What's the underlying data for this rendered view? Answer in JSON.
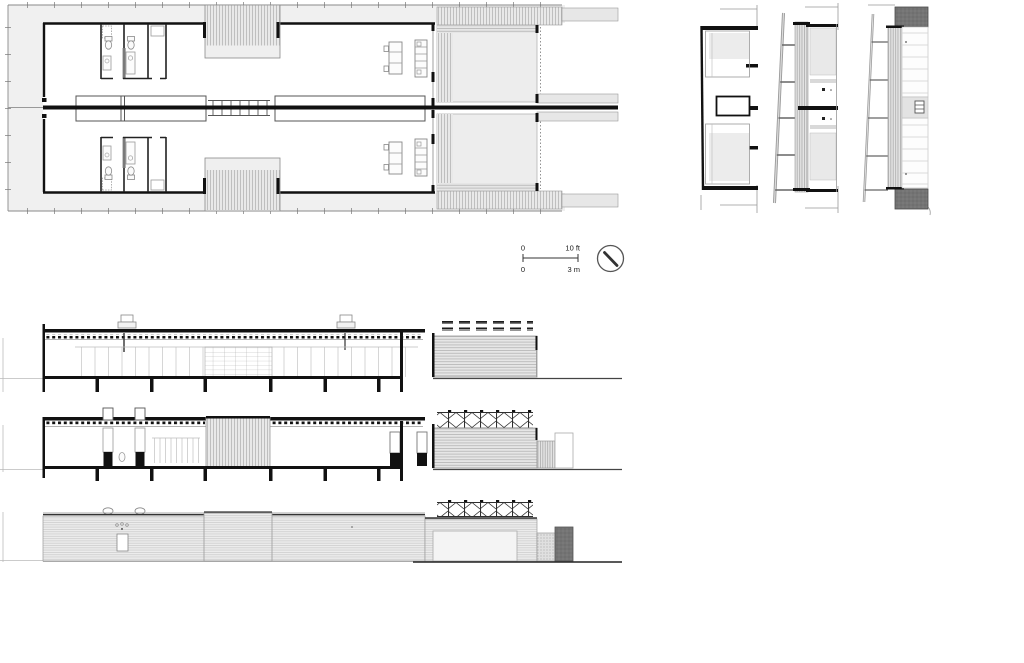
{
  "sheet": {
    "type": "architectural-drawing-sheet",
    "colors": {
      "paper": "#ffffff",
      "ink": "#111111",
      "site_fill": "#f0f0f0",
      "panel_fill": "#ececec",
      "mid_gray": "#999999",
      "dark_block": "#747474"
    }
  },
  "scale_bar": {
    "imperial": {
      "zero": "0",
      "max": "10 ft"
    },
    "metric": {
      "zero": "0",
      "max": "3 m"
    }
  },
  "icons": {
    "north_arrow": "north-arrow-circle-with-needle"
  }
}
